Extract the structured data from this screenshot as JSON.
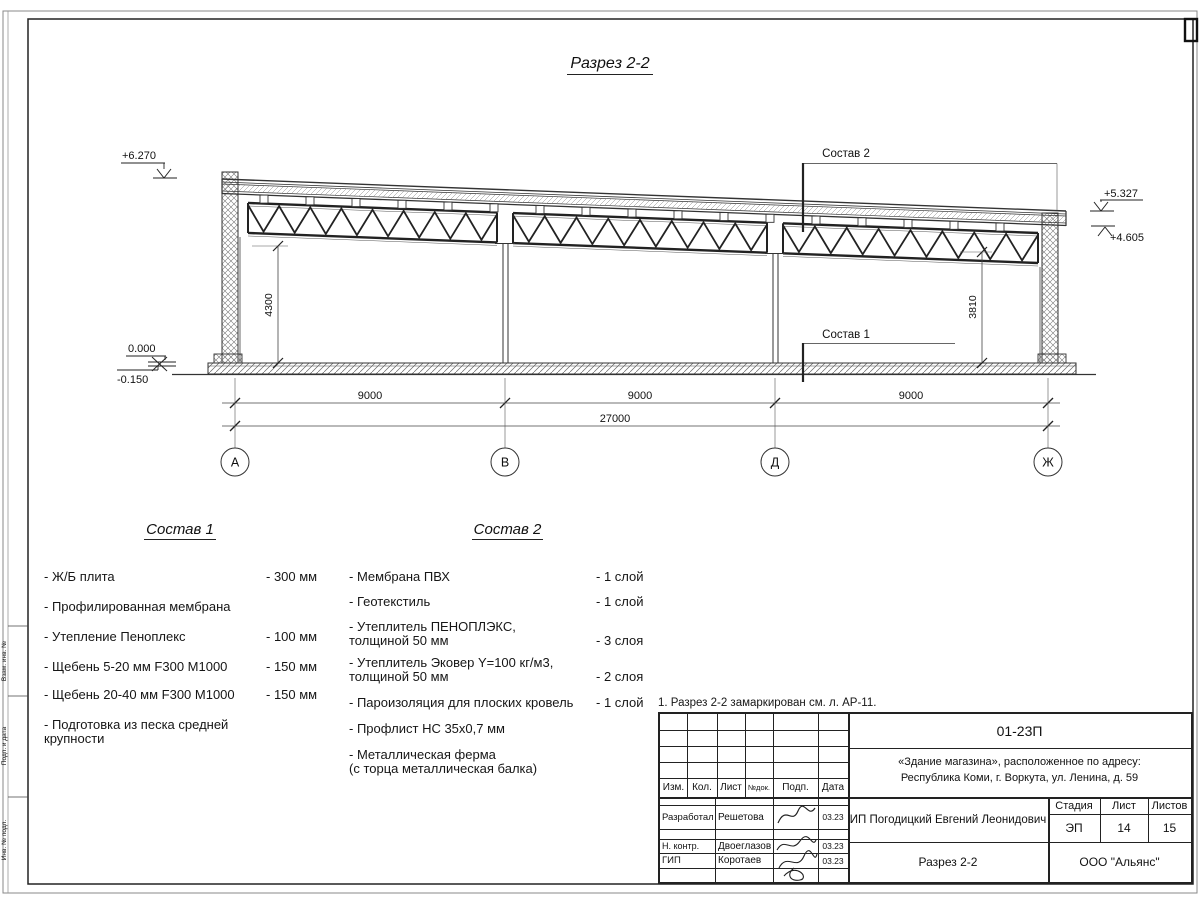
{
  "sheet": {
    "title": "Разрез 2-2",
    "note": "1. Разрез 2-2 замаркирован см. л. АР-11."
  },
  "drawing": {
    "elevations": {
      "top_left": "+6.270",
      "right_upper": "+5.327",
      "right_lower": "+4.605",
      "zero": "0.000",
      "minus": "-0.150"
    },
    "vertical_dims": [
      "4300",
      "3810"
    ],
    "span_dims": [
      "9000",
      "9000",
      "9000"
    ],
    "total_dim": "27000",
    "axes": [
      "А",
      "В",
      "Д",
      "Ж"
    ],
    "leaders": {
      "sostav1": "Состав 1",
      "sostav2": "Состав 2"
    }
  },
  "sostav1": {
    "title": "Состав 1",
    "items": [
      {
        "name": "- Ж/Б плита",
        "value": "- 300 мм"
      },
      {
        "name": "- Профилированная мембрана",
        "value": ""
      },
      {
        "name": "- Утепление Пеноплекс",
        "value": "- 100 мм"
      },
      {
        "name": "-  Щебень 5-20 мм F300 М1000",
        "value": "- 150 мм"
      },
      {
        "name": "-  Щебень 20-40 мм F300 М1000",
        "value": "- 150 мм"
      },
      {
        "name": "- Подготовка из песка средней\n   крупности",
        "value": ""
      }
    ]
  },
  "sostav2": {
    "title": "Состав 2",
    "items": [
      {
        "name": "- Мембрана ПВХ",
        "value": "- 1 слой"
      },
      {
        "name": "- Геотекстиль",
        "value": "- 1 слой"
      },
      {
        "name": "- Утеплитель ПЕНОПЛЭКС,\n   толщиной 50 мм",
        "value": "- 3 слоя"
      },
      {
        "name": "- Утеплитель Эковер Y=100 кг/м3,\n   толщиной 50 мм",
        "value": "- 2 слоя"
      },
      {
        "name": "- Пароизоляция для плоских кровель",
        "value": "- 1 слой"
      },
      {
        "name": "- Профлист НС 35х0,7 мм",
        "value": ""
      },
      {
        "name": "- Металлическая ферма\n   (с торца металлическая балка)",
        "value": ""
      }
    ]
  },
  "titleblock": {
    "doc_number": "01-23П",
    "object_line1": "«Здание магазина», расположенное по адресу:",
    "object_line2": "Республика Коми, г. Воркута, ул. Ленина, д. 59",
    "header_cells": [
      "Изм.",
      "Кол.",
      "Лист",
      "№док.",
      "Подп.",
      "Дата"
    ],
    "rows": [
      {
        "role": "Разработал",
        "name": "Решетова",
        "date": "03.23"
      },
      {
        "role": "Н. контр.",
        "name": "Двоеглазов",
        "date": "03.23"
      },
      {
        "role": "ГИП",
        "name": "Коротаев",
        "date": "03.23"
      }
    ],
    "company": "ИП Погодицкий Евгений Леонидович",
    "stage_label": "Стадия",
    "sheet_label": "Лист",
    "sheets_label": "Листов",
    "stage": "ЭП",
    "sheet_no": "14",
    "sheets_total": "15",
    "drawing_name": "Разрез 2-2",
    "org": "ООО \"Альянс\""
  },
  "side_stamp": [
    "Взам. инв. №",
    "Подп. и дата",
    "Инв. № подл."
  ]
}
